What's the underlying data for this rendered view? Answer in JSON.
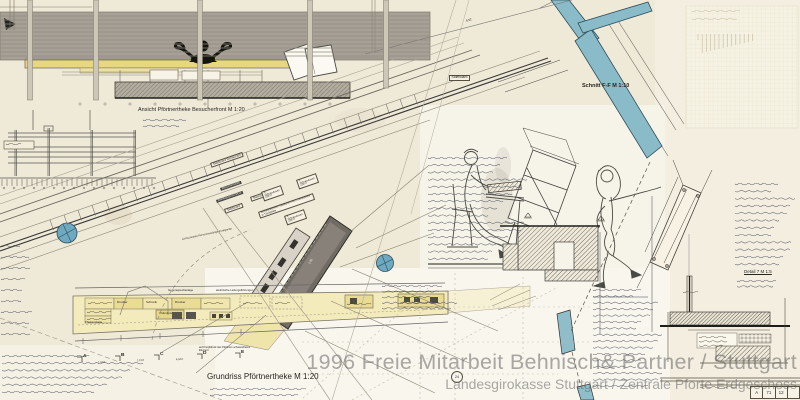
{
  "watermark": {
    "line1": "1996 Freie Mitarbeit Behnisch& Partner / Stuttgart",
    "line2": "Landesgirokasse Stuttgart / Zentrale Pforte Erdgeschoss"
  },
  "titles": {
    "ansicht": "Ansicht Pförtnertheke  Besucherfront   M 1:20",
    "grundriss": "Grundriss Pförtnertheke M 1:20",
    "schnitt": "Schnitt  F-F   M 1:10",
    "detail7": "Detail 7   M 1:5"
  },
  "corridor_labels": {
    "sideboard_top": "Sideboard",
    "sideboard_restaurant": "Sideboard Restaurant",
    "besucherseite": "Besucherseite",
    "briefkastenschlitze": "Briefkastenschlitze",
    "sideboard2": "Sideboard",
    "steckdose": "Steckdose",
    "schuko": "2 Schukodosen 230 V",
    "schrankelement": "Schrankelement Tastaturen mit 2 Steckdosen in Tischplatte",
    "lichtschranke": "Lichtschranke Personenaufzüge Funkgeräte"
  },
  "plan_labels": {
    "gegensprechanlage": "Gegensprechanlage",
    "leitungen": "elektrische Leitungsführungen",
    "knopfdruck": "auf Knopfdruck des Pförtners schwenkbares Element",
    "thekenplatte": "Thekenplatte",
    "cell_drucker1": "Drucker",
    "cell_schrank": "Schrank",
    "cell_drucker2": "Drucker",
    "cell_monitore": "4 Monitore"
  },
  "section_markers": {
    "a": "A",
    "b": "B",
    "c": "C",
    "d": "D",
    "e": "E",
    "circle24": "24"
  },
  "dimensions": {
    "corridor": "8.52",
    "seg1": "1.52½",
    "seg2": "1.12½",
    "seg3": "4.52½",
    "counter": "2.85"
  },
  "titleblock": {
    "c1": "A",
    "c2": "71",
    "c3": "12"
  },
  "colors": {
    "paper": "#efe9d8",
    "accent_blue": "#8abbc9",
    "column_blue": "#6fa9bf",
    "counter_yellow": "#e7d77f",
    "plan_yellow": "#f4ebbd",
    "wall_gray": "#a6a096",
    "counter_dark": "#716c63",
    "watermark_gray": "#696969",
    "ink_blue": "#3d4254"
  }
}
